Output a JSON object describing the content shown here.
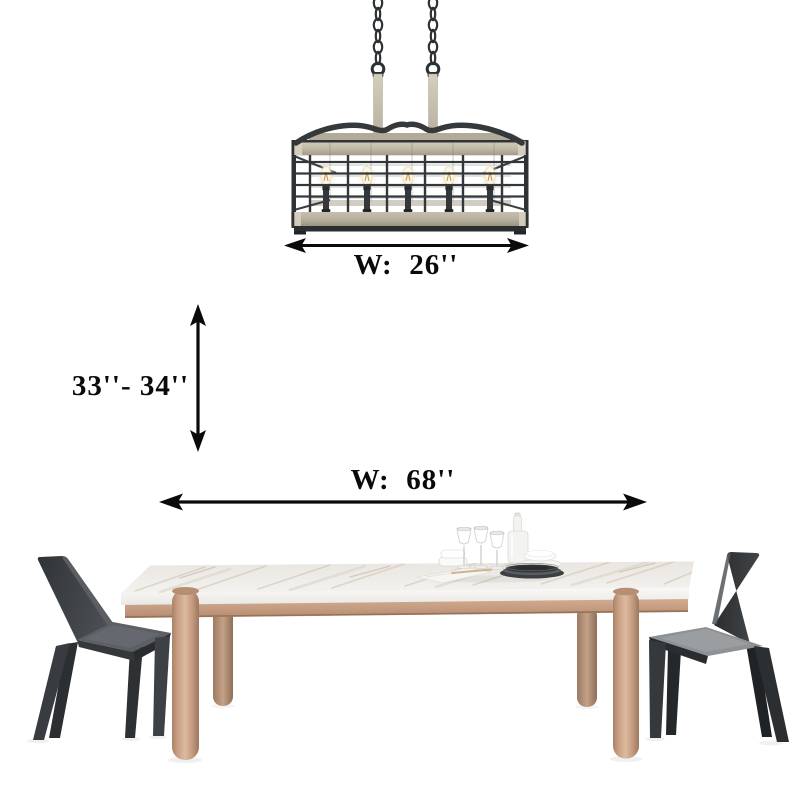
{
  "scene": {
    "background_color": "#ffffff"
  },
  "dimensions": {
    "annotation_color": "#0a0a0a",
    "chandelier_width": {
      "label": "W:  26''"
    },
    "hanging_height": {
      "label": "33''- 34''"
    },
    "table_width": {
      "label": "W:  68''"
    }
  },
  "chandelier": {
    "light_count": "5",
    "metal_color": "#33373a",
    "wood_color": "#c7bfae"
  },
  "table": {
    "marble_color": "#f0eeeb",
    "wood_color": "#c9a188"
  },
  "chairs": {
    "left_color": "#3e4246",
    "right_color": "#27292c"
  }
}
